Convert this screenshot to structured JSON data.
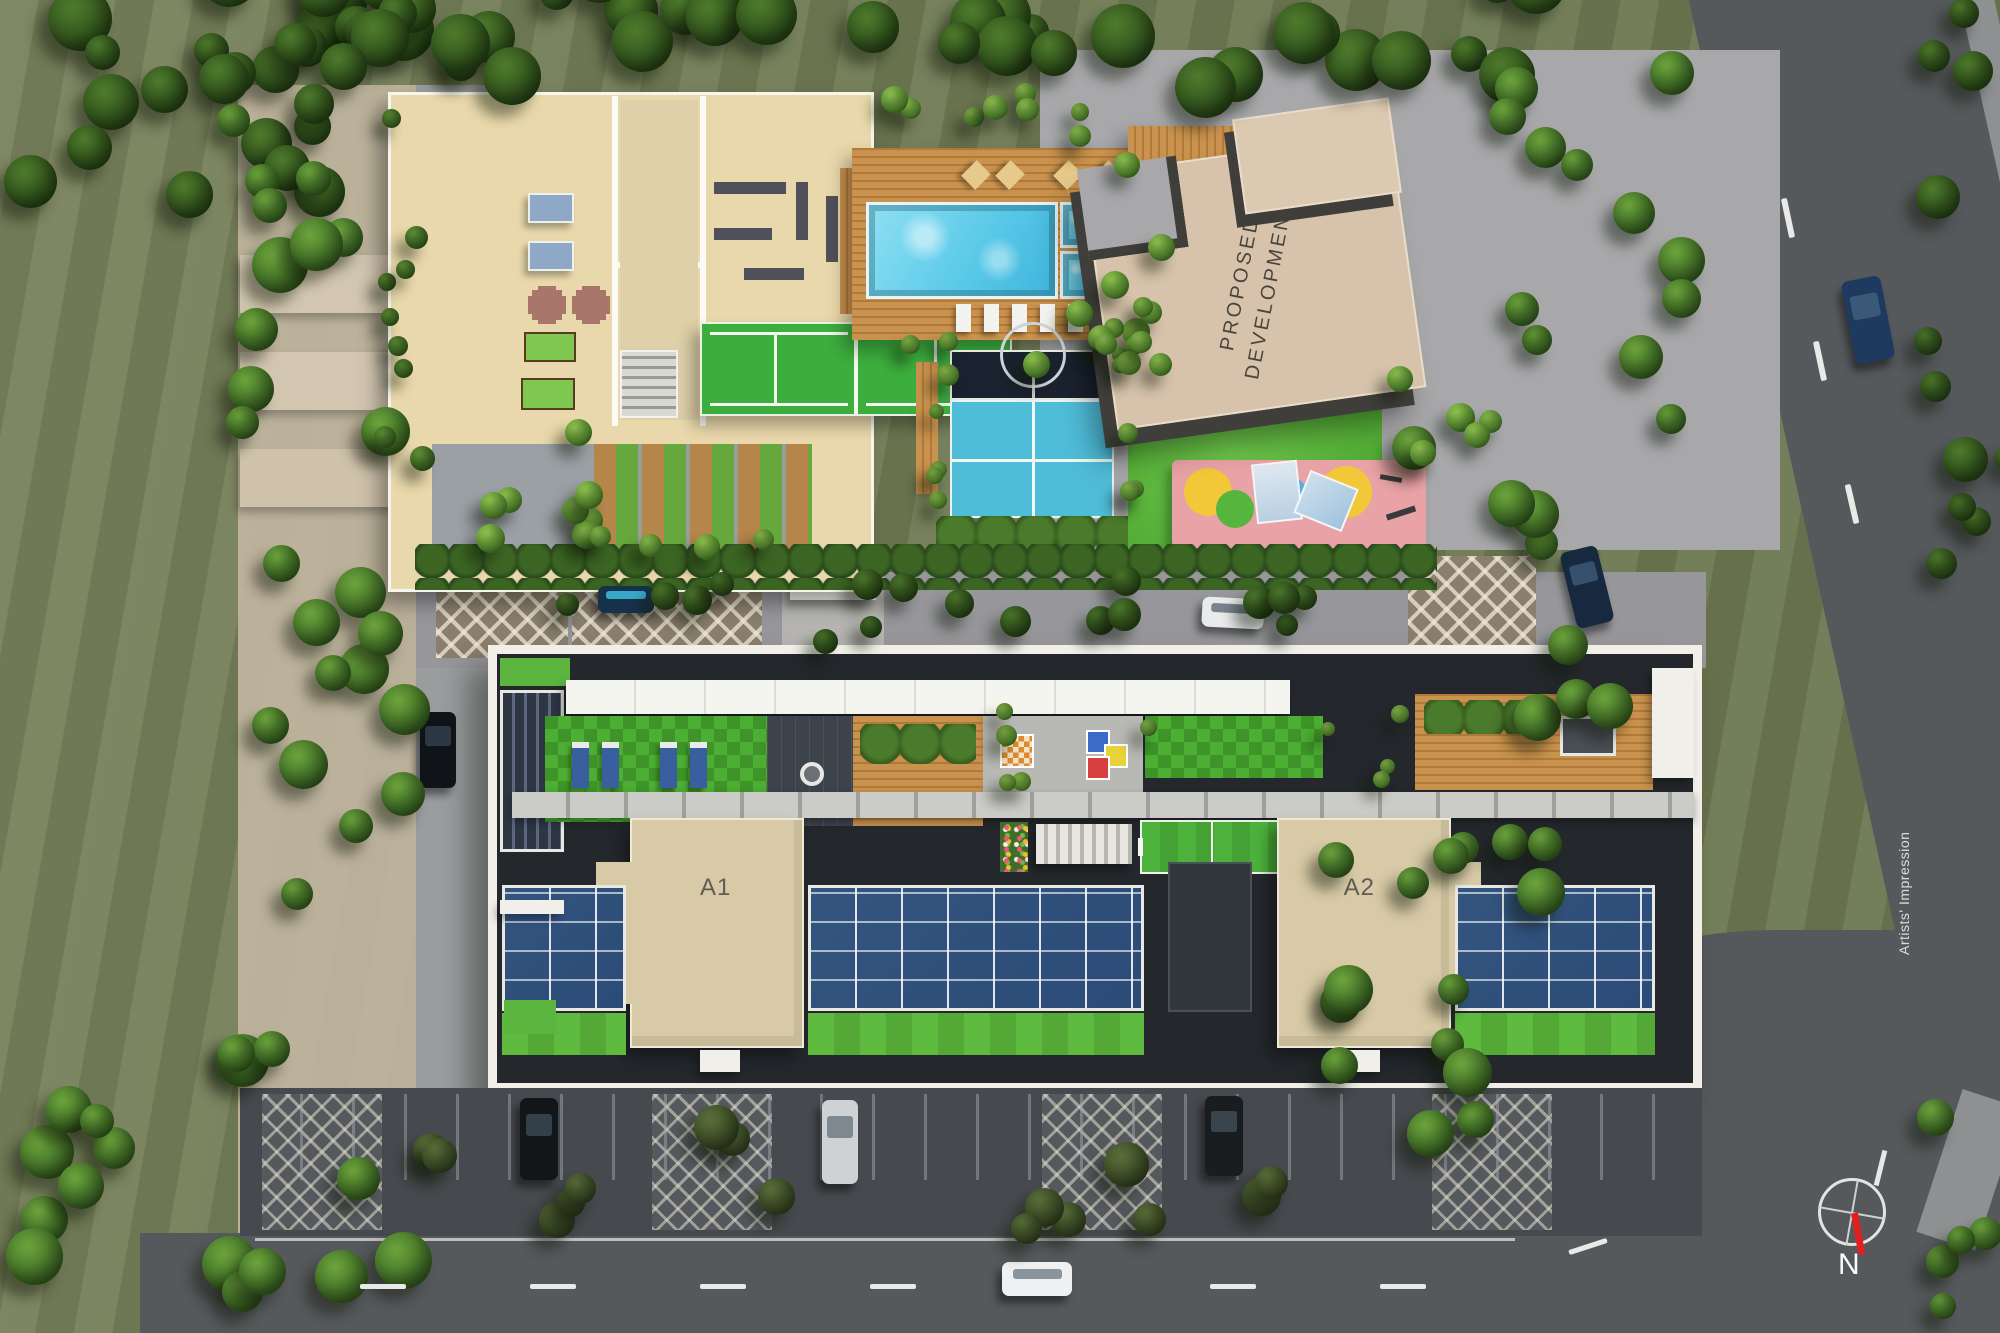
{
  "labels": {
    "tower_a1": "A1",
    "tower_a2": "A2",
    "proposed_development_line1": "PROPOSED",
    "proposed_development_line2": "DEVELOPMENT",
    "artists_impression": "Artists' Impression",
    "compass_north": "N"
  },
  "colors": {
    "pool": "#57c8e8",
    "court-green": "#3cae3e",
    "court-cyan": "#4fbcd8",
    "court-navy": "#19222e",
    "solar": "#2c4b78",
    "beige": "#d8caa6",
    "kids-pink": "#e9a2a6",
    "asphalt": "#56595c",
    "lawn": "#5cb53e",
    "needle-red": "#e02020"
  }
}
